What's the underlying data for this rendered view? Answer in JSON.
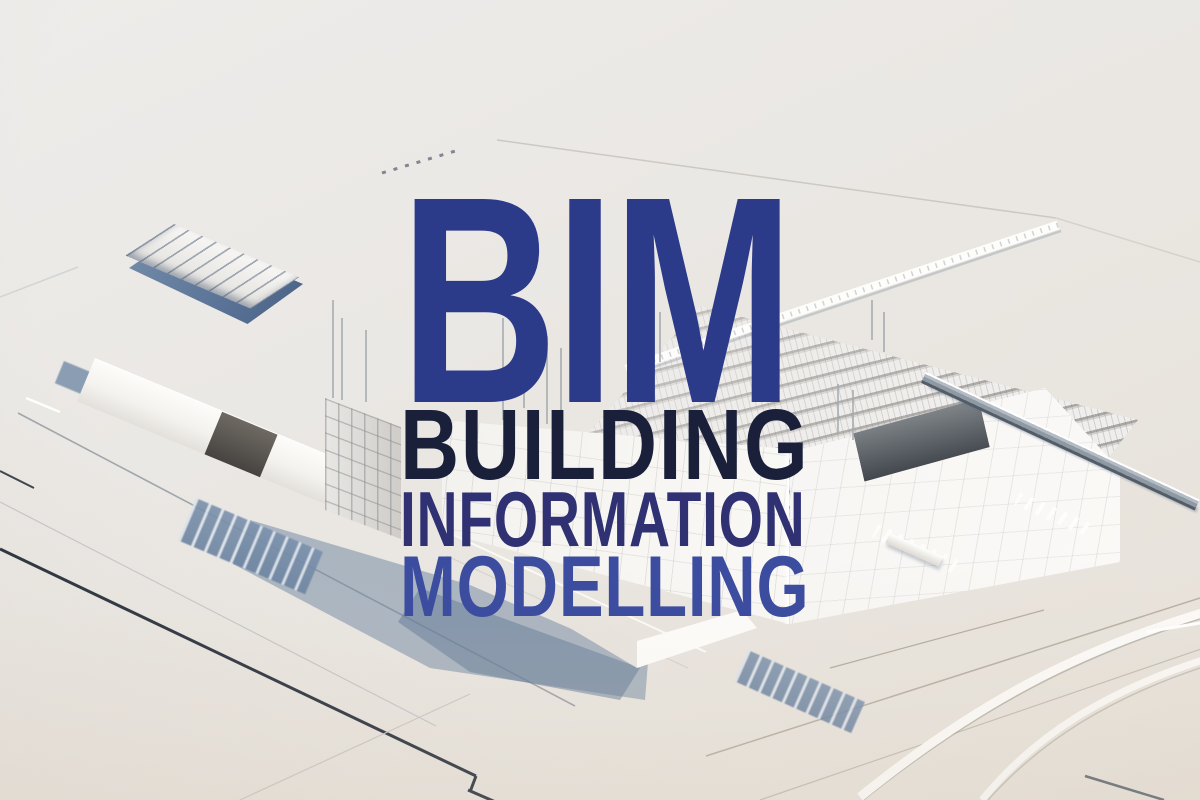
{
  "overlay": {
    "acronym": "BIM",
    "acronym_color": "#2c3a8a",
    "words": [
      {
        "text": "BUILDING",
        "color": "#1a1f3a"
      },
      {
        "text": "INFORMATION",
        "color": "#2f3172"
      },
      {
        "text": "MODELLING",
        "color": "#3c4da0"
      }
    ]
  },
  "scene": {
    "background_color": "#e9e6e2",
    "wall_color": "#f7f5f2",
    "shadow_color": "#7d93ad",
    "courtyard_shadow_color": "#5d7699",
    "road_line_color": "#2a323e"
  }
}
